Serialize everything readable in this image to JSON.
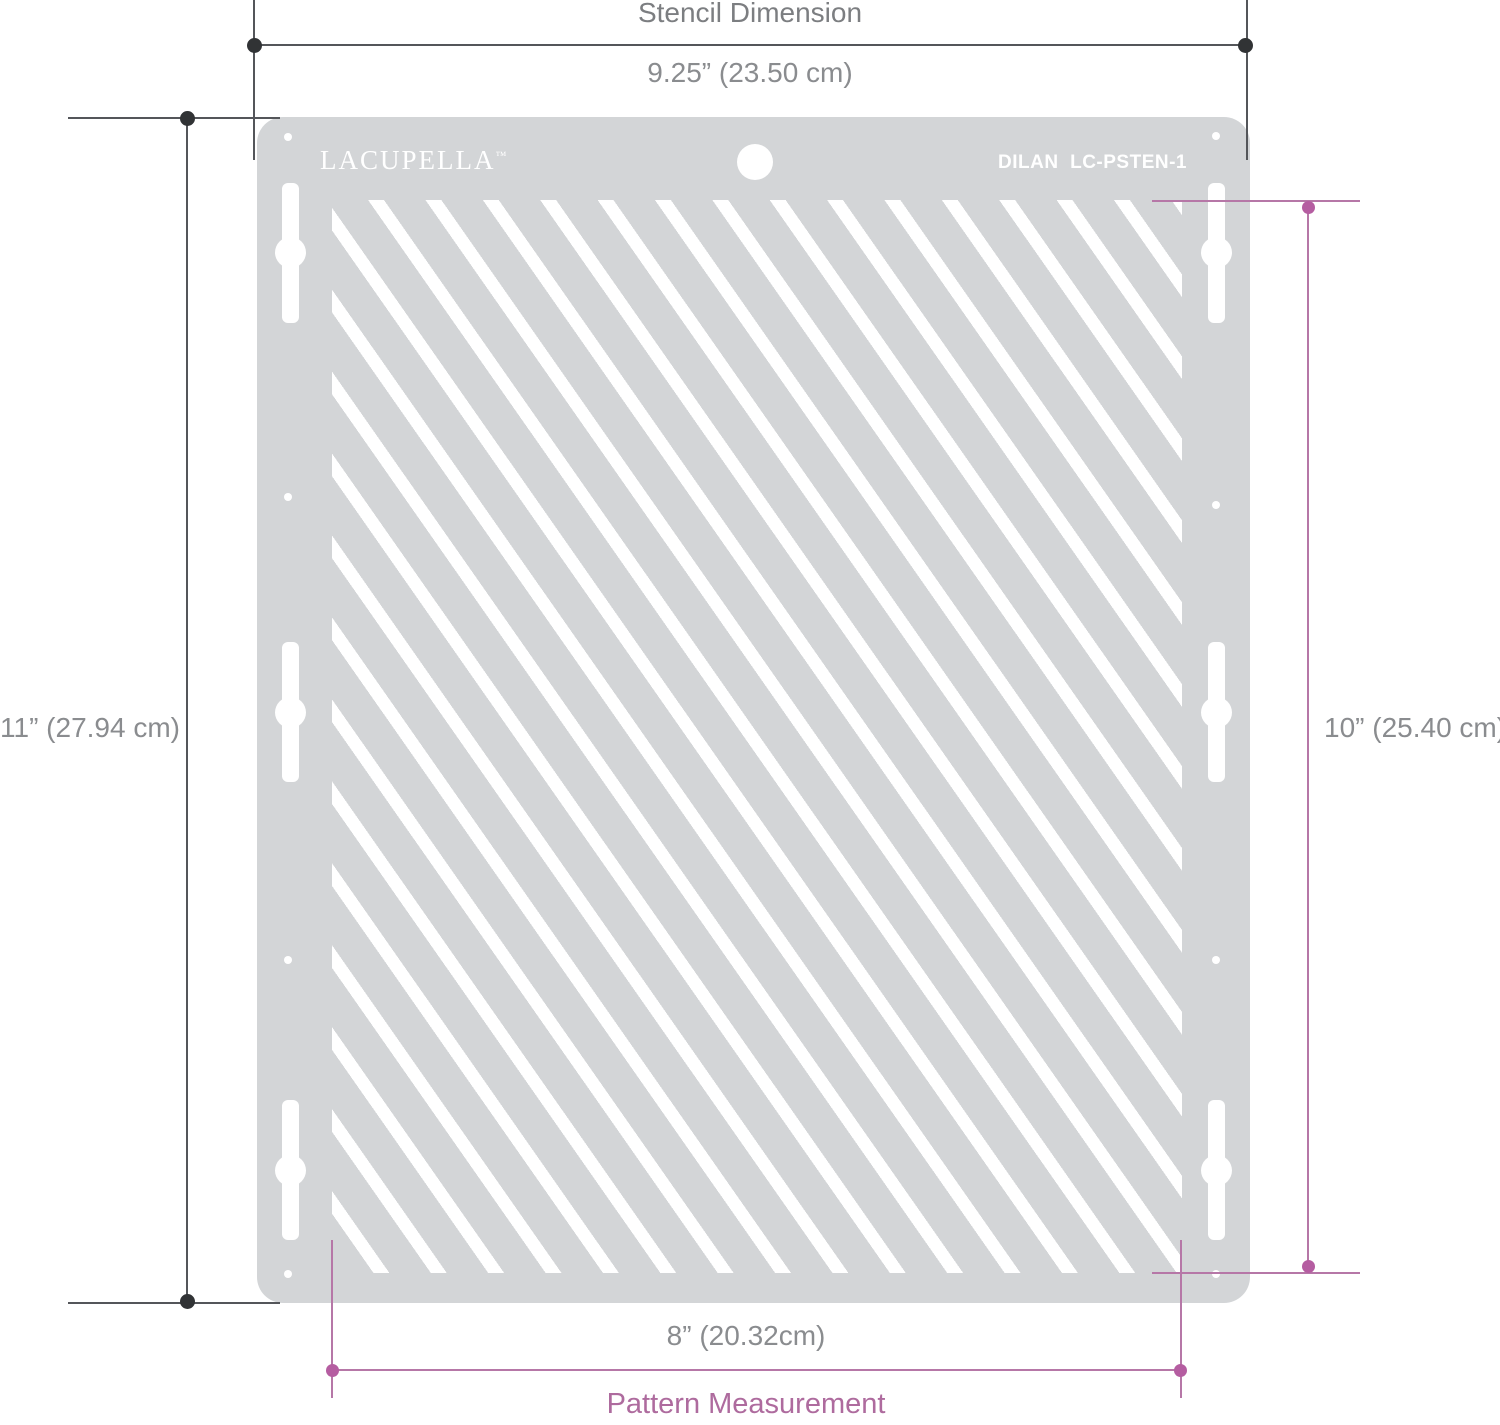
{
  "stencil": {
    "brand": "LACUPELLA",
    "brand_tm": "™",
    "model": "DILAN  LC-PSTEN-1"
  },
  "dimensions": {
    "stencil": {
      "title": "Stencil Dimension",
      "width_label": "9.25” (23.50 cm)",
      "height_label": "11” (27.94 cm)"
    },
    "pattern": {
      "title": "Pattern Measurement",
      "width_label": "8” (20.32cm)",
      "height_label": "10” (25.40 cm)"
    }
  },
  "colors": {
    "plate": "#d3d5d7",
    "stripe": "#ffffff",
    "dark-line": "#54565a",
    "dark-dot": "#313335",
    "pink-line": "#b677a7",
    "pink-dot": "#b55da1",
    "pink-text": "#ae6b9e",
    "gray-text": "#8a8c8f",
    "gray-title": "#7c7e81"
  }
}
